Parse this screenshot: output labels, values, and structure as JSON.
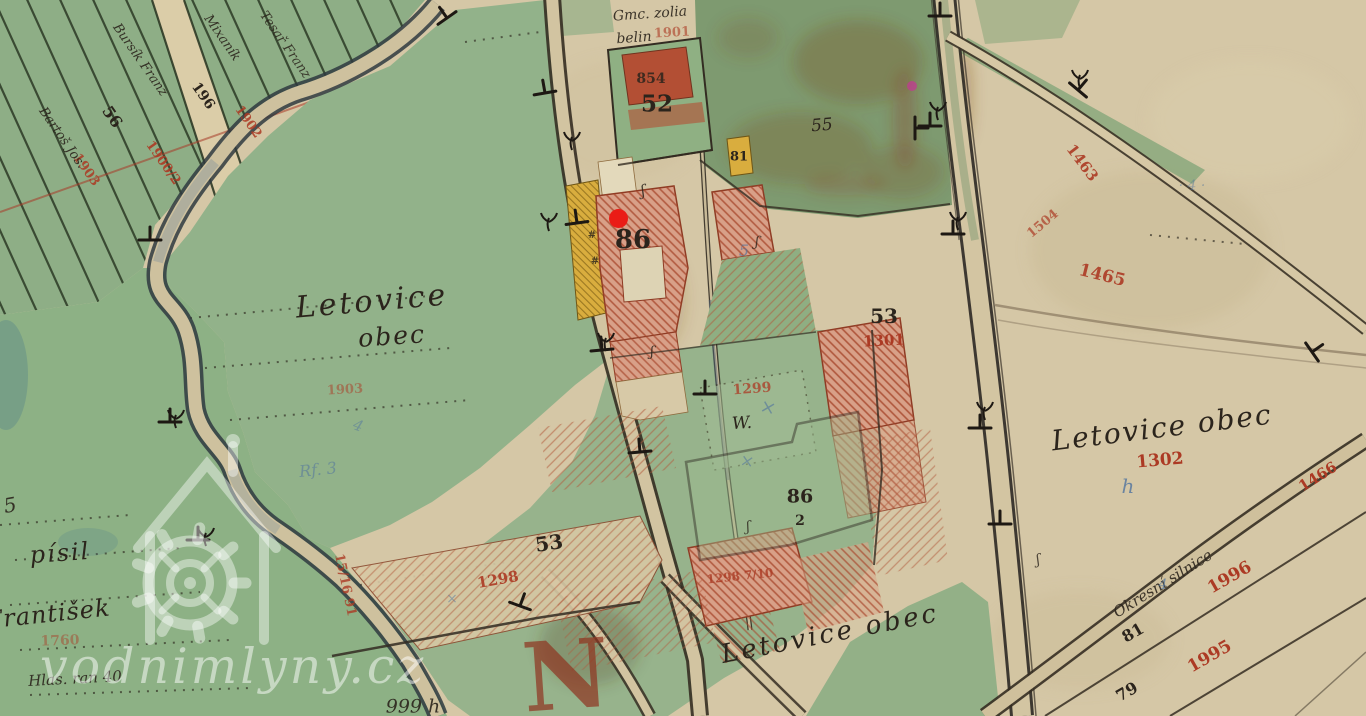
{
  "palette": {
    "paper": "#d5c7a6",
    "meadow_green": "#92b28a",
    "dark_green": "#7e9a70",
    "road_tan": "#d2c4a1",
    "building_pink": "#d8a088",
    "building_red": "#b8452c",
    "building_yellow": "#d9ad3e",
    "ink": "#2b241c",
    "red": "#ac3a24",
    "darkred": "#8f3420",
    "blue": "#50749f",
    "watermark": "#ffffff",
    "marker_red": "#ea1c16"
  },
  "icons": {
    "watermark_icon": "watermill-icon",
    "marker_icon": "location-marker-dot"
  },
  "marker": {
    "x": 618,
    "y": 218,
    "color": "#ea1c16"
  },
  "watermark": {
    "text": "vodnimlyny.cz"
  },
  "map_labels": [
    {
      "t": "86",
      "x": 633,
      "y": 240,
      "s": 26,
      "c": "ink",
      "f": "p"
    },
    {
      "t": "52",
      "x": 657,
      "y": 104,
      "s": 23,
      "c": "ink",
      "f": "p"
    },
    {
      "t": "854",
      "x": 651,
      "y": 79,
      "s": 14,
      "c": "ink",
      "f": "p",
      "o": 0.85
    },
    {
      "t": "81",
      "x": 739,
      "y": 157,
      "s": 13,
      "c": "ink",
      "f": "p"
    },
    {
      "t": "55",
      "x": 822,
      "y": 126,
      "r": -5,
      "s": 17,
      "c": "ink",
      "f": "c"
    },
    {
      "t": "53",
      "x": 884,
      "y": 316,
      "s": 20,
      "c": "ink",
      "f": "p"
    },
    {
      "t": "1301",
      "x": 884,
      "y": 341,
      "r": -3,
      "s": 15,
      "c": "red",
      "f": "p"
    },
    {
      "t": "53",
      "x": 549,
      "y": 543,
      "r": -8,
      "s": 20,
      "c": "ink",
      "f": "p"
    },
    {
      "t": "1298",
      "x": 498,
      "y": 580,
      "r": -10,
      "s": 15,
      "c": "red",
      "f": "p",
      "o": 0.9
    },
    {
      "t": "86",
      "x": 800,
      "y": 497,
      "s": 19,
      "c": "ink",
      "f": "p"
    },
    {
      "t": "2",
      "x": 800,
      "y": 521,
      "s": 14,
      "c": "ink",
      "f": "p"
    },
    {
      "t": "W.",
      "x": 742,
      "y": 424,
      "r": -4,
      "s": 17,
      "c": "ink",
      "f": "c"
    },
    {
      "t": "1299",
      "x": 752,
      "y": 389,
      "r": -4,
      "s": 14,
      "c": "red",
      "f": "p",
      "o": 0.75
    },
    {
      "t": "1298 7/10",
      "x": 740,
      "y": 576,
      "r": -6,
      "s": 12,
      "c": "red",
      "f": "p",
      "o": 0.8
    },
    {
      "t": "56",
      "x": 112,
      "y": 117,
      "r": 55,
      "s": 16,
      "c": "ink",
      "f": "p"
    },
    {
      "t": "196",
      "x": 203,
      "y": 96,
      "r": 55,
      "s": 14,
      "c": "ink",
      "f": "p"
    },
    {
      "t": "1900/2",
      "x": 163,
      "y": 163,
      "r": 55,
      "s": 13,
      "c": "red",
      "f": "p",
      "o": 0.9
    },
    {
      "t": "1902",
      "x": 248,
      "y": 122,
      "r": 55,
      "s": 13,
      "c": "red",
      "f": "p",
      "o": 0.85
    },
    {
      "t": "1903",
      "x": 86,
      "y": 170,
      "r": 55,
      "s": 13,
      "c": "red",
      "f": "p",
      "o": 0.85
    },
    {
      "t": "Mixaník",
      "x": 222,
      "y": 38,
      "r": 55,
      "s": 13,
      "c": "ink",
      "f": "c",
      "o": 0.9
    },
    {
      "t": "Bursík Franz",
      "x": 140,
      "y": 60,
      "r": 55,
      "s": 13,
      "c": "ink",
      "f": "c",
      "o": 0.9
    },
    {
      "t": "Bartoš Jos.",
      "x": 62,
      "y": 138,
      "r": 55,
      "s": 13,
      "c": "ink",
      "f": "c",
      "o": 0.9
    },
    {
      "t": "Tesař Franz",
      "x": 285,
      "y": 45,
      "r": 55,
      "s": 13,
      "c": "ink",
      "f": "c",
      "o": 0.85
    },
    {
      "t": "Letovice",
      "x": 372,
      "y": 302,
      "r": -5,
      "s": 30,
      "c": "ink",
      "f": "c",
      "ls": 3
    },
    {
      "t": "obec",
      "x": 392,
      "y": 336,
      "r": -4,
      "s": 25,
      "c": "ink",
      "f": "c",
      "ls": 2
    },
    {
      "t": "Letovice obec",
      "x": 1162,
      "y": 428,
      "r": -7,
      "s": 28,
      "c": "ink",
      "f": "c",
      "ls": 2
    },
    {
      "t": "1302",
      "x": 1160,
      "y": 461,
      "r": -5,
      "s": 17,
      "c": "red",
      "f": "p"
    },
    {
      "t": "h",
      "x": 1128,
      "y": 486,
      "s": 20,
      "c": "blue",
      "f": "c",
      "o": 0.8
    },
    {
      "t": "Letovice obec",
      "x": 830,
      "y": 634,
      "r": -11,
      "s": 26,
      "c": "ink",
      "f": "c",
      "ls": 3
    },
    {
      "t": "Okresní silnice",
      "x": 1163,
      "y": 584,
      "r": -32,
      "s": 15,
      "c": "ink",
      "f": "c",
      "o": 0.9
    },
    {
      "t": "1466",
      "x": 1318,
      "y": 477,
      "r": -32,
      "s": 15,
      "c": "red",
      "f": "p"
    },
    {
      "t": "81",
      "x": 1133,
      "y": 633,
      "r": -30,
      "s": 16,
      "c": "ink",
      "f": "p"
    },
    {
      "t": "1996",
      "x": 1230,
      "y": 578,
      "r": -30,
      "s": 17,
      "c": "red",
      "f": "p"
    },
    {
      "t": "79",
      "x": 1127,
      "y": 692,
      "r": -30,
      "s": 16,
      "c": "ink",
      "f": "p"
    },
    {
      "t": "1995",
      "x": 1210,
      "y": 657,
      "r": -30,
      "s": 17,
      "c": "red",
      "f": "p"
    },
    {
      "t": "1463",
      "x": 1082,
      "y": 163,
      "r": 53,
      "s": 15,
      "c": "red",
      "f": "p",
      "o": 0.9
    },
    {
      "t": "1465",
      "x": 1102,
      "y": 276,
      "r": 14,
      "s": 17,
      "c": "red",
      "f": "p",
      "o": 0.9
    },
    {
      "t": "1504",
      "x": 1043,
      "y": 224,
      "r": -40,
      "s": 13,
      "c": "red",
      "f": "p",
      "o": 0.7
    },
    {
      "t": "· 4 ·",
      "x": 1192,
      "y": 186,
      "s": 14,
      "c": "blue",
      "f": "c",
      "o": 0.45
    },
    {
      "t": "4",
      "x": 1163,
      "y": 585,
      "s": 14,
      "c": "blue",
      "f": "c",
      "o": 0.7
    },
    {
      "t": "5",
      "x": 744,
      "y": 251,
      "s": 16,
      "c": "blue",
      "f": "c",
      "o": 0.65
    },
    {
      "t": "×",
      "x": 768,
      "y": 408,
      "r": 15,
      "s": 19,
      "c": "blue",
      "f": "c",
      "o": 0.6
    },
    {
      "t": "×",
      "x": 747,
      "y": 462,
      "r": 10,
      "s": 17,
      "c": "blue",
      "f": "c",
      "o": 0.55
    },
    {
      "t": "×",
      "x": 452,
      "y": 599,
      "s": 14,
      "c": "blue",
      "f": "c",
      "o": 0.5
    },
    {
      "t": "Rf. 3",
      "x": 318,
      "y": 470,
      "r": -6,
      "s": 16,
      "c": "blue",
      "f": "c",
      "o": 0.55
    },
    {
      "t": "4",
      "x": 358,
      "y": 426,
      "r": 20,
      "s": 15,
      "c": "blue",
      "f": "c",
      "o": 0.5
    },
    {
      "t": "1903",
      "x": 345,
      "y": 390,
      "r": -3,
      "s": 13,
      "c": "red",
      "f": "p",
      "o": 0.5
    },
    {
      "t": "Gmc. zolia",
      "x": 650,
      "y": 14,
      "r": -4,
      "s": 14,
      "c": "ink",
      "f": "c",
      "o": 0.9
    },
    {
      "t": "belin",
      "x": 634,
      "y": 38,
      "r": -4,
      "s": 14,
      "c": "ink",
      "f": "c",
      "o": 0.9
    },
    {
      "t": "1901",
      "x": 672,
      "y": 33,
      "r": -3,
      "s": 13,
      "c": "red",
      "f": "p",
      "o": 0.6
    },
    {
      "t": "15/16 91",
      "x": 345,
      "y": 585,
      "r": 78,
      "s": 13,
      "c": "red",
      "f": "p",
      "o": 0.8
    },
    {
      "t": "999 h",
      "x": 413,
      "y": 707,
      "s": 19,
      "c": "ink",
      "f": "c",
      "o": 0.9
    },
    {
      "t": "písil",
      "x": 60,
      "y": 553,
      "r": -4,
      "s": 24,
      "c": "ink",
      "f": "c",
      "ls": 2
    },
    {
      "t": "František",
      "x": 48,
      "y": 614,
      "r": -6,
      "s": 24,
      "c": "ink",
      "f": "c",
      "ls": 1
    },
    {
      "t": "Hlas. ran 40",
      "x": 75,
      "y": 679,
      "r": -3,
      "s": 15,
      "c": "ink",
      "f": "c",
      "o": 0.9
    },
    {
      "t": "1760",
      "x": 60,
      "y": 641,
      "r": -2,
      "s": 14,
      "c": "red",
      "f": "p",
      "o": 0.45
    },
    {
      "t": "5",
      "x": 10,
      "y": 505,
      "r": -10,
      "s": 20,
      "c": "ink",
      "f": "c",
      "o": 0.9
    },
    {
      "t": "N",
      "x": 566,
      "y": 676,
      "r": -4,
      "s": 95,
      "c": "darkred",
      "f": "p",
      "o": 0.7
    },
    {
      "t": "ʃ",
      "x": 643,
      "y": 191,
      "r": -10,
      "s": 15,
      "c": "ink",
      "f": "c",
      "o": 0.85
    },
    {
      "t": "ʃ",
      "x": 757,
      "y": 242,
      "r": 5,
      "s": 14,
      "c": "ink",
      "f": "c",
      "o": 0.8
    },
    {
      "t": "ʃ",
      "x": 652,
      "y": 352,
      "s": 14,
      "c": "ink",
      "f": "c",
      "o": 0.85
    },
    {
      "t": "ʃ",
      "x": 748,
      "y": 527,
      "r": -5,
      "s": 14,
      "c": "ink",
      "f": "c",
      "o": 0.8
    },
    {
      "t": "ʃ",
      "x": 1038,
      "y": 560,
      "r": -10,
      "s": 14,
      "c": "ink",
      "f": "c",
      "o": 0.8
    },
    {
      "t": "#",
      "x": 592,
      "y": 236,
      "s": 10,
      "c": "ink",
      "f": "p",
      "o": 0.8
    },
    {
      "t": "#",
      "x": 595,
      "y": 262,
      "s": 10,
      "c": "ink",
      "f": "p",
      "o": 0.8
    }
  ]
}
